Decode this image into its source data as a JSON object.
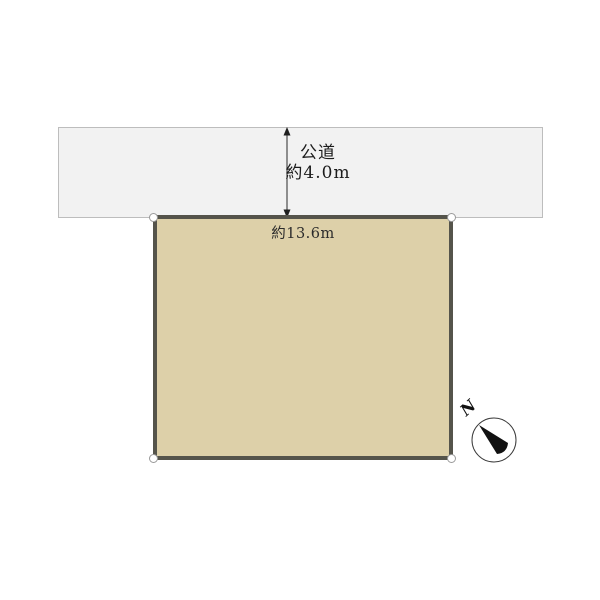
{
  "road": {
    "name_label": "公道",
    "width_label": "約4.0m"
  },
  "parcel": {
    "frontage_label": "約13.6m"
  },
  "compass": {
    "north_label": "N"
  },
  "colors": {
    "road-fill": "#F2F2F2",
    "road-border": "#BDBDBD",
    "parcel-fill": "#DDD0A9",
    "parcel-border": "#55544B",
    "marker-border": "#9A9A9A",
    "arrow-color": "#1F1F1F"
  }
}
